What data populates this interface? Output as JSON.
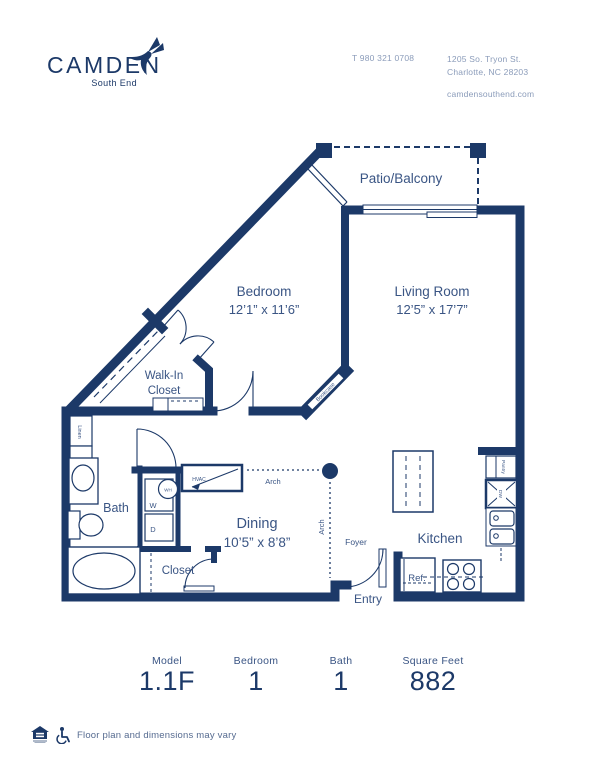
{
  "header": {
    "brand": "CAMDEN",
    "brand_sub": "South End",
    "phone": "T 980 321 0708",
    "address_line1": "1205 So. Tryon St.",
    "address_line2": "Charlotte, NC 28203",
    "website": "camdensouthend.com"
  },
  "floorplan": {
    "labels": {
      "patio": "Patio/Balcony",
      "bedroom": "Bedroom",
      "bedroom_dims": "12’1” x 11’6”",
      "living": "Living Room",
      "living_dims": "12’5” x 17’7”",
      "walkin_1": "Walk-In",
      "walkin_2": "Closet",
      "bath": "Bath",
      "dining": "Dining",
      "dining_dims": "10’5” x 8’8”",
      "kitchen": "Kitchen",
      "closet": "Closet",
      "foyer": "Foyer",
      "entry": "Entry",
      "linen": "Linen",
      "bookcase": "Bookcase",
      "water_heater": "WH",
      "washer": "W",
      "dryer": "D",
      "hvac": "HVAC",
      "arch_horizontal": "Arch",
      "arch_vertical": "Arch",
      "refrigerator": "Ref.",
      "pantry": "Pantry",
      "dishwasher": "DW"
    }
  },
  "stats": [
    {
      "label": "Model",
      "value": "1.1F"
    },
    {
      "label": "Bedroom",
      "value": "1"
    },
    {
      "label": "Bath",
      "value": "1"
    },
    {
      "label": "Square Feet",
      "value": "882"
    }
  ],
  "footer": {
    "disclaimer": "Floor plan and dimensions may vary"
  },
  "colors": {
    "wall_navy": "#1c3968",
    "label_blue": "#3a5584",
    "muted_slate": "#8b9cba"
  }
}
